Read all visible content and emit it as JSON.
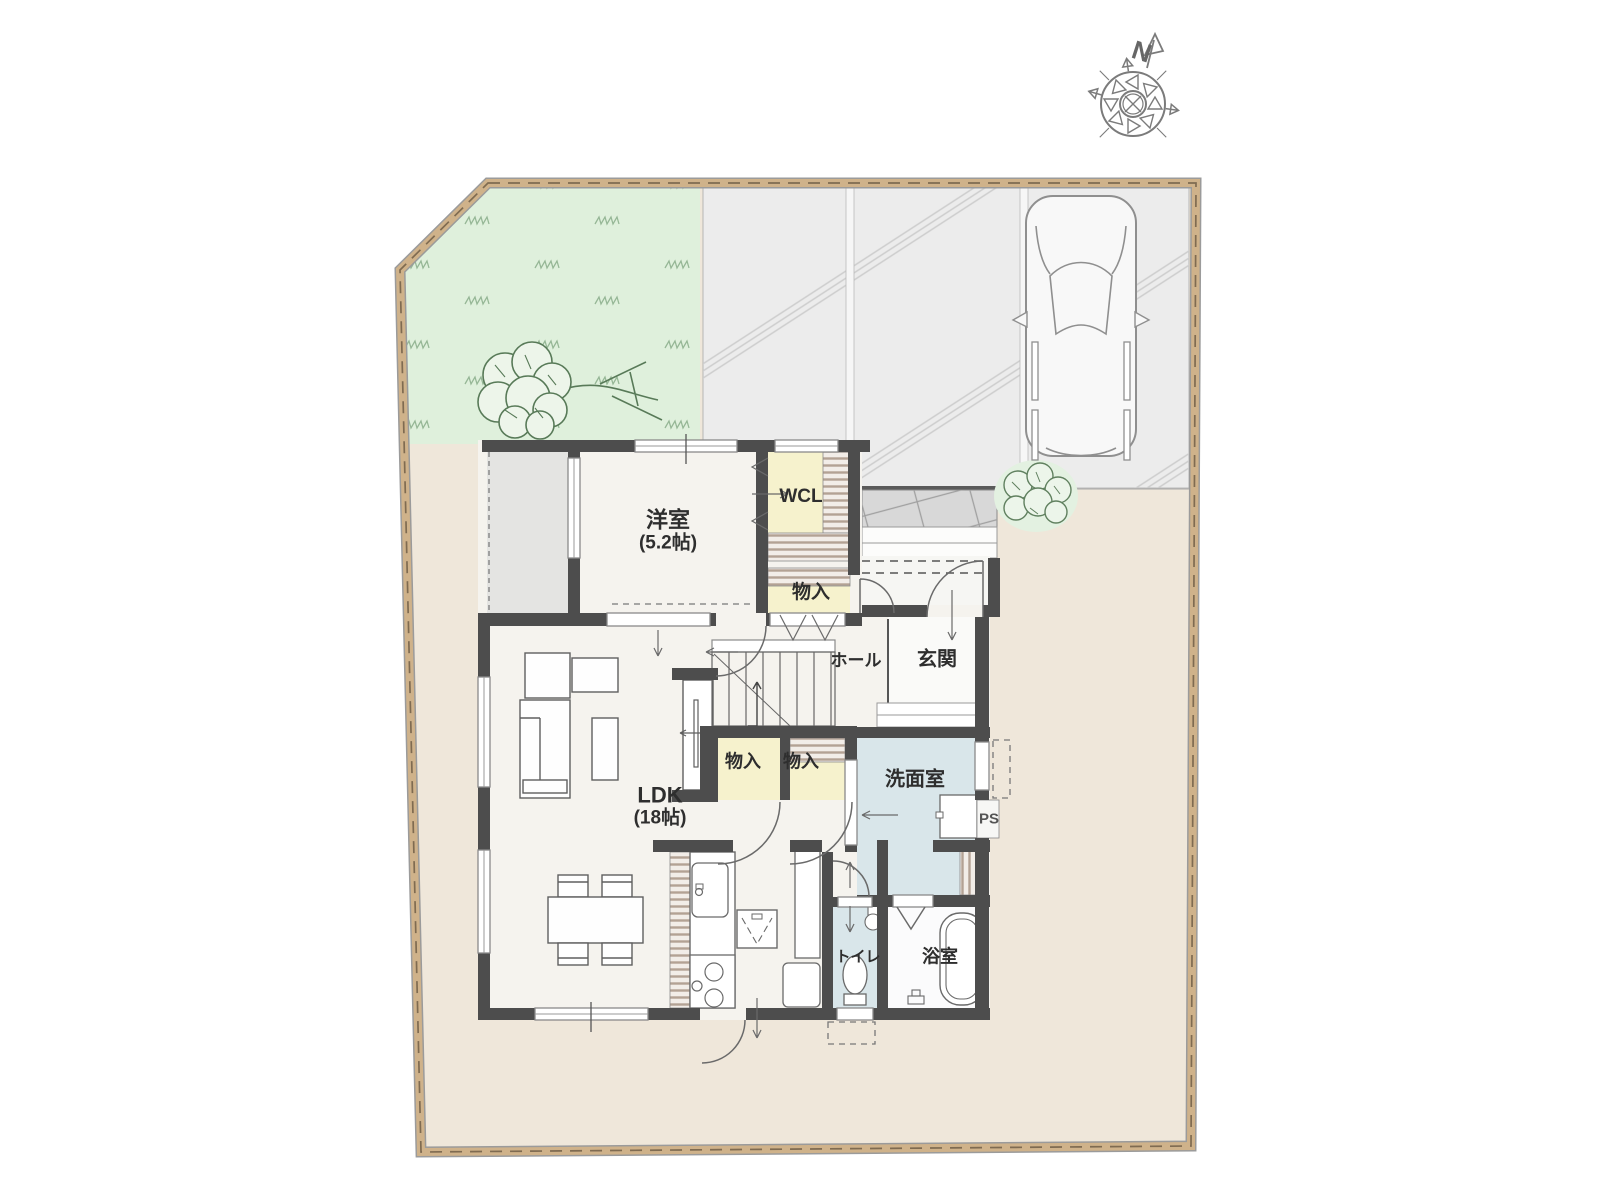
{
  "floor_plan": {
    "compass": {
      "north_label": "N"
    },
    "rooms": {
      "western_room": {
        "label": "洋室",
        "size_label": "(5.2帖)"
      },
      "walk_in_closet": {
        "label": "WCL"
      },
      "storage_upper": {
        "label": "物入"
      },
      "storage_stairs_left": {
        "label": "物入"
      },
      "storage_stairs_right": {
        "label": "物入"
      },
      "hall": {
        "label": "ホール"
      },
      "entrance": {
        "label": "玄関"
      },
      "washroom": {
        "label": "洗面室"
      },
      "pipe_space": {
        "label": "PS"
      },
      "ldk": {
        "label": "LDK",
        "size_label": "(18帖)"
      },
      "toilet": {
        "label": "トイレ"
      },
      "bathroom": {
        "label": "浴室"
      }
    },
    "colors": {
      "wall": "#4d4d4d",
      "closet_fill": "#f6f2cd",
      "wet_area_fill": "#d9e6ea",
      "floor_fill": "#f5f3ee",
      "garden_fill": "#dff0dc",
      "driveway_fill": "#ececec",
      "yard_fill": "#efe7da",
      "site_border": "#cfb28a",
      "terrace_fill": "#e4e4e2"
    }
  }
}
